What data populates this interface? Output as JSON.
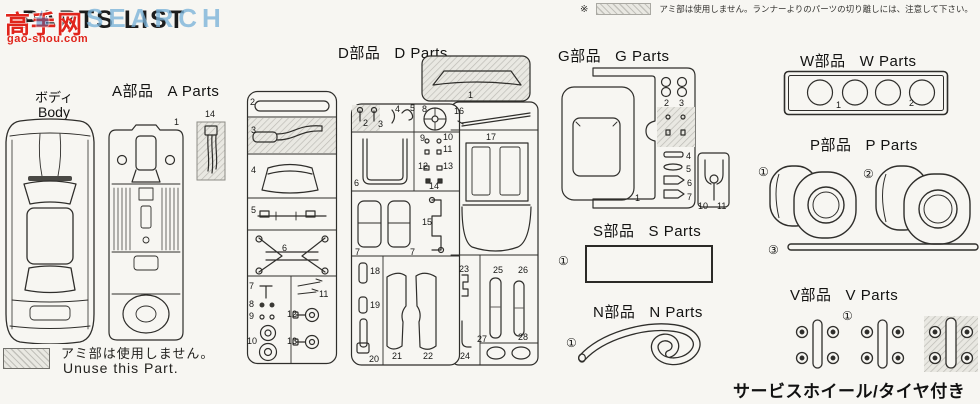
{
  "watermark": {
    "logo": "高手网",
    "site": "gao-shou.com",
    "overlay": "SEARCH"
  },
  "header": {
    "title": "PARTS LIST",
    "note_symbol": "※",
    "note_text": "アミ部は使用しません。ランナーよりのパーツの切り離しには、注意して下さい。"
  },
  "body_section": {
    "label_jp": "ボディ",
    "label_en": "Body"
  },
  "a_section": {
    "label_jp": "A部品",
    "label_en": "A Parts",
    "num_chassis": "1",
    "num_extra": "14"
  },
  "d_section": {
    "label_jp": "D部品",
    "label_en": "D Parts",
    "runner1_nums": [
      "2",
      "3",
      "4",
      "5",
      "6",
      "7",
      "8",
      "9",
      "10",
      "11",
      "12",
      "13"
    ],
    "runner2_nums": [
      "1",
      "2",
      "3",
      "4",
      "5",
      "8",
      "9",
      "10",
      "11",
      "12",
      "13",
      "14",
      "6",
      "7",
      "7",
      "15",
      "16",
      "17",
      "18",
      "19",
      "20",
      "21",
      "22",
      "23",
      "24",
      "25",
      "26",
      "27",
      "28"
    ]
  },
  "g_section": {
    "label_jp": "G部品",
    "label_en": "G Parts",
    "nums": [
      "1",
      "2",
      "3",
      "4",
      "5",
      "6",
      "7",
      "10",
      "11"
    ]
  },
  "s_section": {
    "label_jp": "S部品",
    "label_en": "S Parts",
    "num": "①"
  },
  "n_section": {
    "label_jp": "N部品",
    "label_en": "N Parts",
    "num": "①"
  },
  "w_section": {
    "label_jp": "W部品",
    "label_en": "W Parts",
    "nums": [
      "1",
      "2"
    ]
  },
  "p_section": {
    "label_jp": "P部品",
    "label_en": "P Parts",
    "nums": [
      "①",
      "②",
      "③"
    ]
  },
  "v_section": {
    "label_jp": "V部品",
    "label_en": "V Parts",
    "num": "①"
  },
  "legend": {
    "jp": "アミ部は使用しません。",
    "en": "Unuse this Part."
  },
  "footer_note": "サービスホイール/タイヤ付き",
  "colors": {
    "ink": "#2f2e2b",
    "watermark_red": "#e0251c",
    "overlay_blue": "#7ab2d8"
  }
}
